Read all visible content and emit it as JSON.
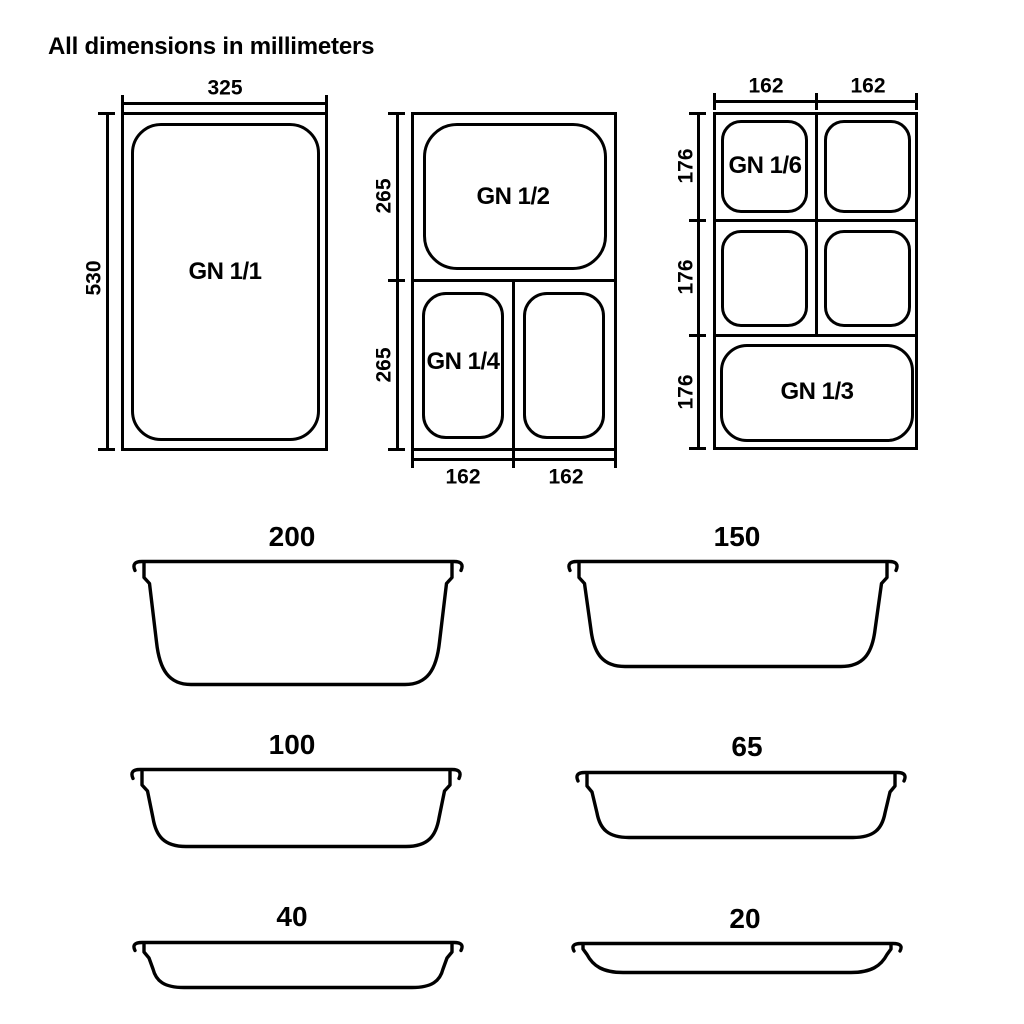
{
  "title": "All dimensions in millimeters",
  "colors": {
    "line": "#000000",
    "background": "#ffffff"
  },
  "top_views": {
    "full": {
      "label": "GN 1/1",
      "width_mm": "325",
      "height_mm": "530"
    },
    "half_quarter": {
      "half_label": "GN 1/2",
      "quarter_label": "GN 1/4",
      "top_height_mm": "265",
      "bottom_height_mm": "265",
      "left_width_mm": "162",
      "right_width_mm": "162"
    },
    "sixth_third": {
      "sixth_label": "GN 1/6",
      "third_label": "GN 1/3",
      "left_width_mm": "162",
      "right_width_mm": "162",
      "row1_height_mm": "176",
      "row2_height_mm": "176",
      "row3_height_mm": "176"
    }
  },
  "depth_profiles": [
    {
      "depth_mm": "200"
    },
    {
      "depth_mm": "150"
    },
    {
      "depth_mm": "100"
    },
    {
      "depth_mm": "65"
    },
    {
      "depth_mm": "40"
    },
    {
      "depth_mm": "20"
    }
  ]
}
